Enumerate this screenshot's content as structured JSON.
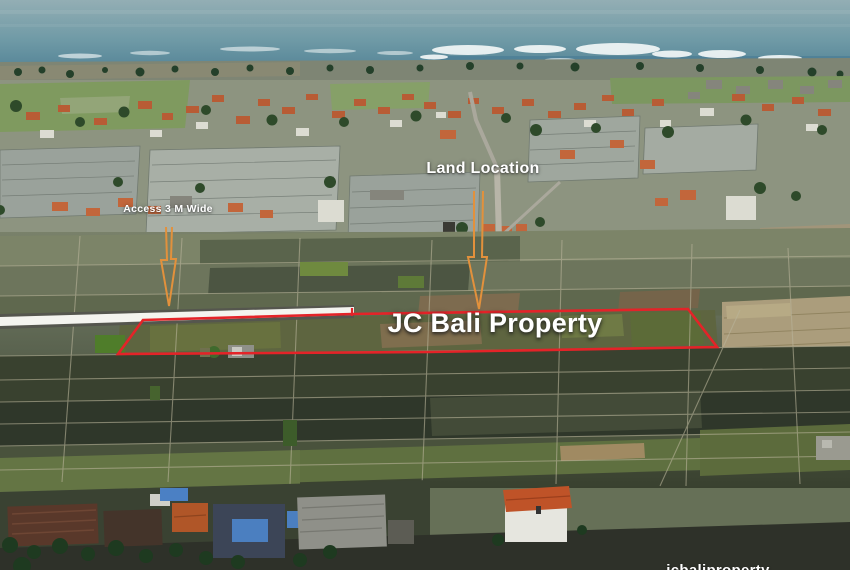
{
  "scene": {
    "type": "aerial-drone-photograph",
    "subject": "land plot for sale among rice fields with coastal village and ocean"
  },
  "annotations": {
    "land_location": {
      "label": "Land Location"
    },
    "access": {
      "label": "Access 3 M Wide"
    },
    "property": {
      "label": "JC Bali Property"
    },
    "watermark": {
      "label": "jcbaliproperty"
    }
  },
  "colors": {
    "plot_outline": "#e42328",
    "arrow": "#e2913c",
    "road_highlight": "#f4f4ef",
    "label_text": "#ffffff",
    "ocean_top": "#93aeb4",
    "ocean_deep": "#49798e"
  }
}
